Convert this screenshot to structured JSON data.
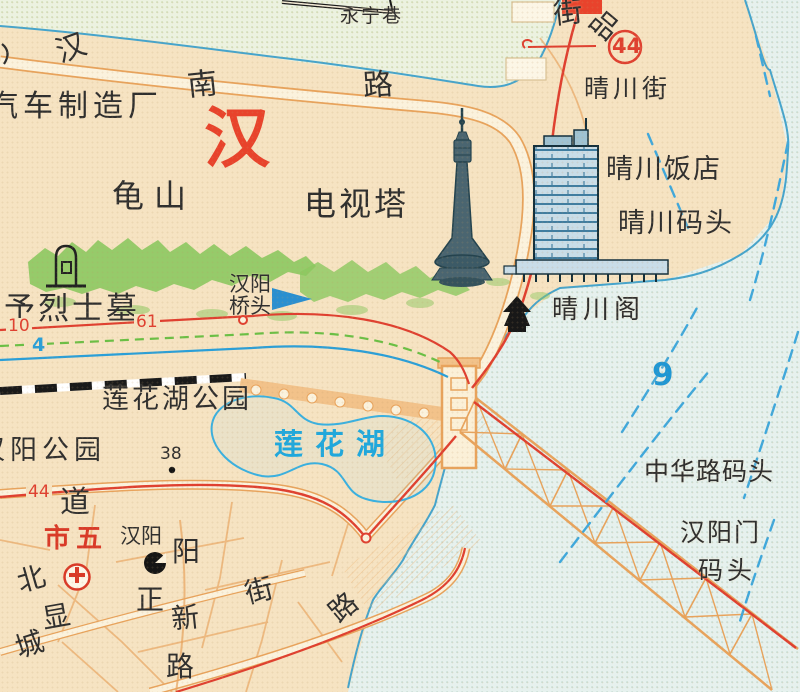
{
  "colors": {
    "paper": "#f6e3c2",
    "water_green": "#ecf2e0",
    "water_green_dot": "#c9dcae",
    "water_blue": "#e6f1ee",
    "water_blue_dot": "#bcdcd6",
    "shoreline": "#45a4cc",
    "route_red": "#df4030",
    "red_accent": "#e8432c",
    "route_blue": "#2a9fd8",
    "tram_green": "#6abf45",
    "ferry_blue": "#3fa8dc",
    "lake_blue": "#39b0e0",
    "mountain_green": "#8cc860",
    "road_border": "#e8a35c",
    "road_fill": "#fbf2dd",
    "bridge_orange": "#f2c28a",
    "railway": "#1a1a1a",
    "ink": "#2f2f2f",
    "building_ink": "#14303c",
    "building_fill": "#c9dde8",
    "building_lines": "#2d6f96",
    "tower_fill": "#4a6570",
    "tower_dark": "#24434e"
  },
  "icons": [
    {
      "name": "tv-tower-illustration",
      "represents": "电视塔"
    },
    {
      "name": "hotel-building-illustration",
      "represents": "晴川饭店"
    },
    {
      "name": "pagoda-icon",
      "represents": "晴川阁"
    },
    {
      "name": "tomb-icon",
      "represents": "烈士墓"
    },
    {
      "name": "hospital-icon",
      "represents": "市五 医院"
    },
    {
      "name": "station-icon",
      "represents": "汉阳"
    },
    {
      "name": "bridgehead-arrow-icon",
      "represents": "汉阳桥头"
    },
    {
      "name": "spot-elevation-dot",
      "represents": "38"
    },
    {
      "name": "route-44-ring",
      "represents": "44 路"
    },
    {
      "name": "yangtze-bridge-illustration",
      "represents": "长江大桥"
    },
    {
      "name": "railway-line",
      "represents": "铁路"
    }
  ],
  "labels": [
    {
      "name": "label-hannan-road-char1",
      "text": "汉",
      "x": 52,
      "y": 40,
      "size": 30,
      "rotate": -20
    },
    {
      "name": "label-hannan-road-char2",
      "text": "南",
      "x": 186,
      "y": 72,
      "size": 30,
      "rotate": -6
    },
    {
      "name": "label-hannan-road-char3",
      "text": "路",
      "x": 362,
      "y": 72,
      "size": 30,
      "rotate": -4
    },
    {
      "name": "label-yongning-lane",
      "text": "永宁巷",
      "x": 340,
      "y": 7,
      "size": 19,
      "spacing": 2
    },
    {
      "name": "label-jie-top",
      "text": "街",
      "x": 552,
      "y": 0,
      "size": 29,
      "rotate": -6
    },
    {
      "name": "label-pin-top",
      "text": "品",
      "x": 602,
      "y": 6,
      "size": 28,
      "rotate": 40
    },
    {
      "name": "label-qingchuan-street",
      "text": "晴川街",
      "x": 584,
      "y": 76,
      "size": 25,
      "spacing": 4
    },
    {
      "name": "label-auto-factory",
      "text": "汽车制造厂",
      "x": -12,
      "y": 92,
      "size": 30,
      "spacing": 5
    },
    {
      "name": "label-hanyang-big-red",
      "text": "汉",
      "x": 204,
      "y": 106,
      "size": 66,
      "color": "#e8432c",
      "weight": "bold"
    },
    {
      "name": "label-guishan",
      "text": "龟山",
      "x": 112,
      "y": 180,
      "size": 32,
      "spacing": 10
    },
    {
      "name": "label-tv-tower",
      "text": "电视塔",
      "x": 304,
      "y": 188,
      "size": 32,
      "spacing": 3
    },
    {
      "name": "label-qingchuan-hotel",
      "text": "晴川饭店",
      "x": 606,
      "y": 156,
      "size": 27,
      "spacing": 2
    },
    {
      "name": "label-qingchuan-wharf",
      "text": "晴川码头",
      "x": 618,
      "y": 210,
      "size": 27,
      "spacing": 2
    },
    {
      "name": "label-martyr-tomb",
      "text": "予烈士墓",
      "x": 4,
      "y": 294,
      "size": 31,
      "spacing": 3
    },
    {
      "name": "label-hanyang-qiaotou-1",
      "text": "汉阳",
      "x": 229,
      "y": 274,
      "size": 21
    },
    {
      "name": "label-hanyang-qiaotou-2",
      "text": "桥头",
      "x": 229,
      "y": 296,
      "size": 21
    },
    {
      "name": "label-qingchuan-pavilion",
      "text": "晴川阁",
      "x": 552,
      "y": 297,
      "size": 26,
      "spacing": 5
    },
    {
      "name": "label-lianhua-lake-park",
      "text": "莲花湖公园",
      "x": 102,
      "y": 386,
      "size": 27,
      "spacing": 3
    },
    {
      "name": "label-hanyang-park",
      "text": "汉阳公园",
      "x": -22,
      "y": 437,
      "size": 27,
      "spacing": 5
    },
    {
      "name": "label-spot-height-38",
      "text": "38",
      "x": 160,
      "y": 446,
      "size": 17
    },
    {
      "name": "label-lianhua-lake",
      "text": "莲花湖",
      "x": 274,
      "y": 430,
      "size": 29,
      "color": "#1fa8dd",
      "weight": "bold",
      "spacing": 12
    },
    {
      "name": "label-ferry-route-9",
      "text": "9",
      "x": 652,
      "y": 360,
      "size": 31,
      "color": "#1f97d4",
      "weight": "bold"
    },
    {
      "name": "label-zhonghua-wharf",
      "text": "中华路码头",
      "x": 644,
      "y": 459,
      "size": 25,
      "spacing": 1
    },
    {
      "name": "label-hanyangmen-wharf-1",
      "text": "汉阳门",
      "x": 680,
      "y": 520,
      "size": 25,
      "spacing": 2
    },
    {
      "name": "label-hanyangmen-wharf-2",
      "text": "码头",
      "x": 698,
      "y": 558,
      "size": 25,
      "spacing": 4
    },
    {
      "name": "label-dao",
      "text": "道",
      "x": 60,
      "y": 488,
      "size": 30
    },
    {
      "name": "label-shiwu-hospital",
      "text": "市五",
      "x": 44,
      "y": 526,
      "size": 26,
      "color": "#d93a28",
      "weight": "bold",
      "spacing": 6
    },
    {
      "name": "label-hanyang-station",
      "text": "汉阳",
      "x": 120,
      "y": 526,
      "size": 21
    },
    {
      "name": "label-yang",
      "text": "阳",
      "x": 172,
      "y": 538,
      "size": 28
    },
    {
      "name": "label-bei",
      "text": "北",
      "x": 14,
      "y": 570,
      "size": 28,
      "rotate": -16
    },
    {
      "name": "label-xian",
      "text": "显",
      "x": 40,
      "y": 606,
      "size": 28,
      "rotate": -10
    },
    {
      "name": "label-cheng",
      "text": "城",
      "x": 12,
      "y": 636,
      "size": 28,
      "rotate": -18
    },
    {
      "name": "label-zheng",
      "text": "正",
      "x": 136,
      "y": 586,
      "size": 28
    },
    {
      "name": "label-xin",
      "text": "新",
      "x": 170,
      "y": 606,
      "size": 28,
      "rotate": -6
    },
    {
      "name": "label-jie-xianzheng",
      "text": "街",
      "x": 242,
      "y": 581,
      "size": 28,
      "rotate": -14
    },
    {
      "name": "label-lu-yangxin",
      "text": "路",
      "x": 166,
      "y": 653,
      "size": 28
    },
    {
      "name": "label-lu-riverside",
      "text": "路",
      "x": 324,
      "y": 606,
      "size": 28,
      "rotate": -40
    },
    {
      "name": "marker-route-10",
      "text": "10",
      "x": 6,
      "y": 318,
      "size": 17,
      "color": "#df4030",
      "bg": "#f6e3c2"
    },
    {
      "name": "marker-route-61",
      "text": "61",
      "x": 134,
      "y": 314,
      "size": 17,
      "color": "#df4030",
      "bg": "#f6e3c2"
    },
    {
      "name": "marker-route-4",
      "text": "4",
      "x": 30,
      "y": 336,
      "size": 19,
      "color": "#2a9fd8",
      "weight": "bold",
      "bg": "#f6e3c2"
    },
    {
      "name": "marker-route-44-circled",
      "text": "44",
      "x": 612,
      "y": 36,
      "size": 21,
      "color": "#df4030",
      "weight": "bold"
    },
    {
      "name": "marker-route-44-avenue",
      "text": "44",
      "x": 26,
      "y": 484,
      "size": 17,
      "color": "#df4030",
      "bg": "#f6e3c2"
    }
  ]
}
